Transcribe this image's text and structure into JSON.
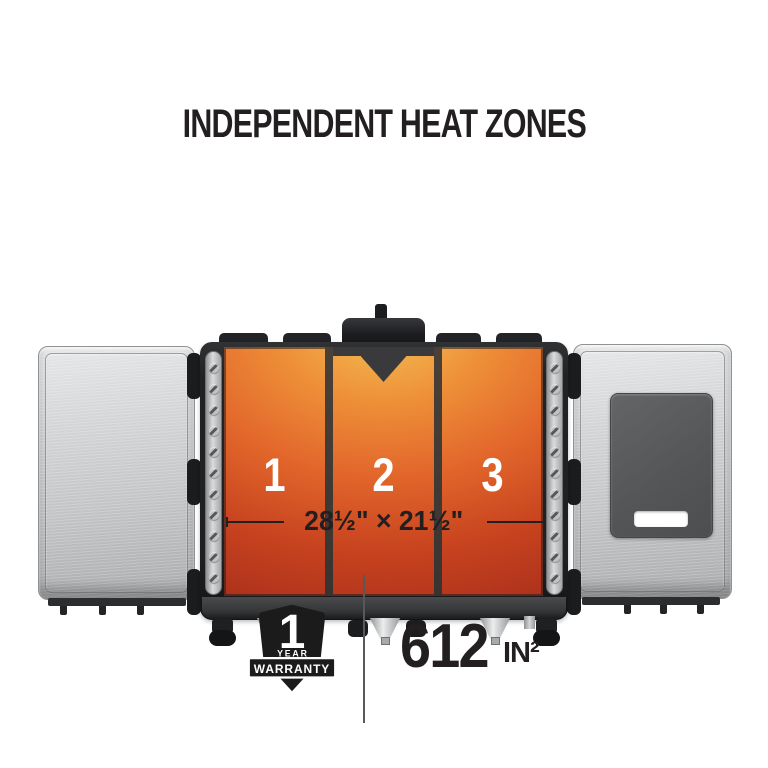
{
  "title": "INDEPENDENT HEAT ZONES",
  "griddle": {
    "zone_labels": [
      "1",
      "2",
      "3"
    ],
    "rail_screw_count": 11
  },
  "icons": {
    "rail_screw": "slotted-screw-icon",
    "grease_chute": "v-notch-chute-icon"
  },
  "dimensions": {
    "label": "28½\" × 21½\""
  },
  "warranty_badge": {
    "number": "1",
    "year_label": "YEAR",
    "ribbon_label": "WARRANTY"
  },
  "cooking_area": {
    "value": "612",
    "unit": "IN²"
  },
  "colors": {
    "ink": "#231f20",
    "heat-top": "#f4c055",
    "heat-upper": "#ee9038",
    "heat-mid": "#e2662b",
    "heat-deep": "#c8431f",
    "heat-bottom": "#a52d1b",
    "frame": "#212224",
    "metal-light": "#d4d5d7",
    "metal-dark": "#a9abad",
    "board": "#57595b",
    "zone-number": "#ffffff"
  }
}
